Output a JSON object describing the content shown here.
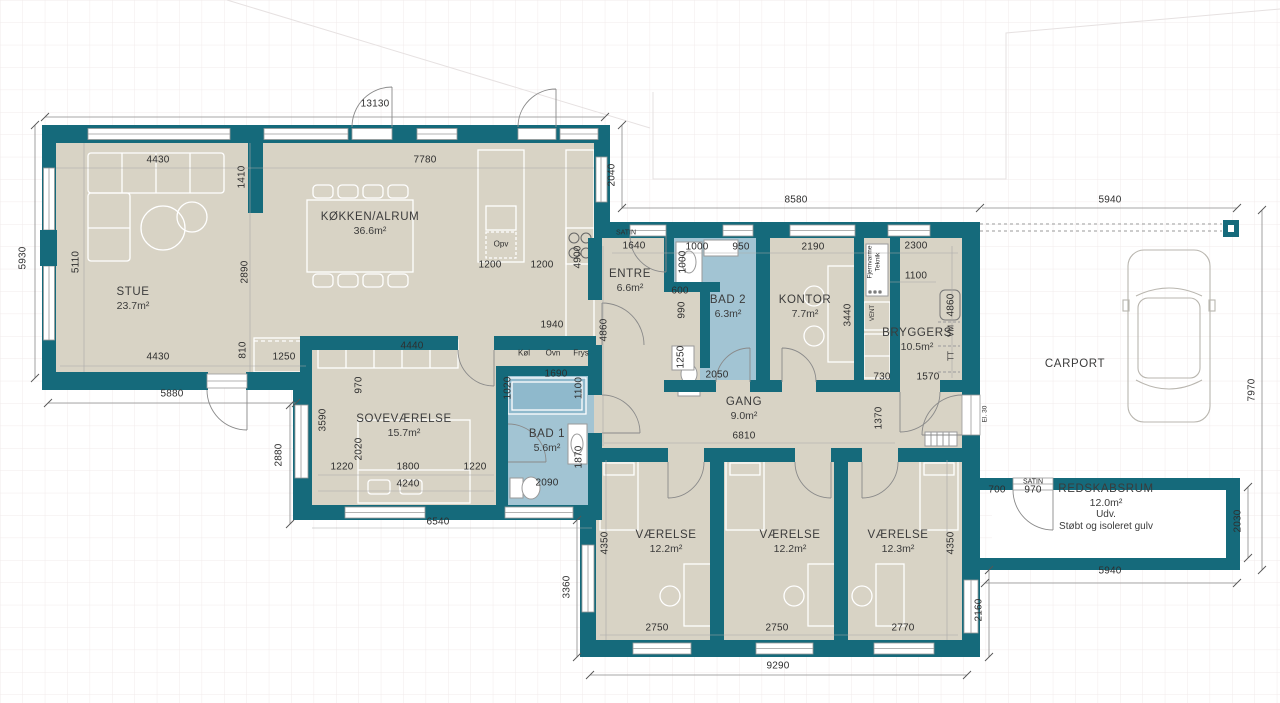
{
  "plan": {
    "colors": {
      "wall": "#156a7b",
      "floor": "#d8d3c5",
      "wet_floor": "#a2c4d3",
      "shower": "#8fb9cc",
      "grid": "#f1ebeb",
      "dim_line": "#8a8a8a",
      "furniture_line": "#ffffff"
    },
    "rooms": [
      {
        "name": "STUE",
        "area": "23.7m²",
        "x": 133,
        "y": 299
      },
      {
        "name": "KØKKEN/ALRUM",
        "area": "36.6m²",
        "x": 370,
        "y": 224
      },
      {
        "name": "SOVEVÆRELSE",
        "area": "15.7m²",
        "x": 404,
        "y": 426
      },
      {
        "name": "BAD 1",
        "area": "5.6m²",
        "x": 547,
        "y": 441
      },
      {
        "name": "ENTRE",
        "area": "6.6m²",
        "x": 630,
        "y": 281
      },
      {
        "name": "BAD 2",
        "area": "6.3m²",
        "x": 728,
        "y": 307
      },
      {
        "name": "KONTOR",
        "area": "7.7m²",
        "x": 805,
        "y": 307
      },
      {
        "name": "BRYGGERS",
        "area": "10.5m²",
        "x": 917,
        "y": 340
      },
      {
        "name": "GANG",
        "area": "9.0m²",
        "x": 744,
        "y": 409
      },
      {
        "name": "VÆRELSE",
        "area": "12.2m²",
        "x": 666,
        "y": 542
      },
      {
        "name": "VÆRELSE",
        "area": "12.2m²",
        "x": 790,
        "y": 542
      },
      {
        "name": "VÆRELSE",
        "area": "12.3m²",
        "x": 898,
        "y": 542
      },
      {
        "name": "CARPORT",
        "area": "",
        "x": 1075,
        "y": 365
      },
      {
        "name": "REDSKABSRUM",
        "area": "12.0m²",
        "x": 1106,
        "y": 508,
        "lines": [
          "Udv.",
          "Støbt og isoleret gulv"
        ]
      }
    ],
    "dims": [
      {
        "t": "13130",
        "x": 375,
        "y": 104
      },
      {
        "t": "4430",
        "x": 158,
        "y": 160
      },
      {
        "t": "7780",
        "x": 425,
        "y": 160
      },
      {
        "t": "1200",
        "x": 490,
        "y": 265
      },
      {
        "t": "1200",
        "x": 542,
        "y": 265
      },
      {
        "t": "4430",
        "x": 158,
        "y": 357
      },
      {
        "t": "1250",
        "x": 284,
        "y": 357
      },
      {
        "t": "4440",
        "x": 412,
        "y": 346
      },
      {
        "t": "1940",
        "x": 552,
        "y": 325
      },
      {
        "t": "1690",
        "x": 556,
        "y": 374
      },
      {
        "t": "2090",
        "x": 547,
        "y": 483
      },
      {
        "t": "5880",
        "x": 172,
        "y": 394
      },
      {
        "t": "1220",
        "x": 342,
        "y": 467
      },
      {
        "t": "1800",
        "x": 408,
        "y": 467
      },
      {
        "t": "1220",
        "x": 475,
        "y": 467
      },
      {
        "t": "4240",
        "x": 408,
        "y": 484
      },
      {
        "t": "6540",
        "x": 438,
        "y": 522
      },
      {
        "t": "1640",
        "x": 634,
        "y": 246
      },
      {
        "t": "1000",
        "x": 697,
        "y": 247
      },
      {
        "t": "950",
        "x": 741,
        "y": 247
      },
      {
        "t": "2190",
        "x": 813,
        "y": 247
      },
      {
        "t": "2300",
        "x": 916,
        "y": 246
      },
      {
        "t": "1100",
        "x": 916,
        "y": 276
      },
      {
        "t": "600",
        "x": 680,
        "y": 291
      },
      {
        "t": "2050",
        "x": 717,
        "y": 375
      },
      {
        "t": "730",
        "x": 882,
        "y": 377
      },
      {
        "t": "1570",
        "x": 928,
        "y": 377
      },
      {
        "t": "8580",
        "x": 796,
        "y": 200
      },
      {
        "t": "5940",
        "x": 1110,
        "y": 200
      },
      {
        "t": "6810",
        "x": 744,
        "y": 436
      },
      {
        "t": "2750",
        "x": 657,
        "y": 628
      },
      {
        "t": "2750",
        "x": 777,
        "y": 628
      },
      {
        "t": "2770",
        "x": 903,
        "y": 628
      },
      {
        "t": "9290",
        "x": 778,
        "y": 666
      },
      {
        "t": "700",
        "x": 997,
        "y": 490
      },
      {
        "t": "970",
        "x": 1033,
        "y": 490
      },
      {
        "t": "5940",
        "x": 1110,
        "y": 571
      },
      {
        "t": "5930",
        "x": 23,
        "y": 258,
        "r": 1
      },
      {
        "t": "5110",
        "x": 76,
        "y": 262,
        "r": 1
      },
      {
        "t": "1410",
        "x": 242,
        "y": 177,
        "r": 1
      },
      {
        "t": "2890",
        "x": 245,
        "y": 272,
        "r": 1
      },
      {
        "t": "810",
        "x": 243,
        "y": 350,
        "r": 1
      },
      {
        "t": "2040",
        "x": 612,
        "y": 175,
        "r": 1
      },
      {
        "t": "4900",
        "x": 578,
        "y": 257,
        "r": 1
      },
      {
        "t": "4860",
        "x": 604,
        "y": 330,
        "r": 1
      },
      {
        "t": "1000",
        "x": 683,
        "y": 262,
        "r": 1
      },
      {
        "t": "990",
        "x": 682,
        "y": 310,
        "r": 1
      },
      {
        "t": "1250",
        "x": 681,
        "y": 357,
        "r": 1
      },
      {
        "t": "3440",
        "x": 848,
        "y": 315,
        "r": 1
      },
      {
        "t": "4860",
        "x": 951,
        "y": 305,
        "r": 1
      },
      {
        "t": "1020",
        "x": 508,
        "y": 388,
        "r": 1
      },
      {
        "t": "1100",
        "x": 579,
        "y": 388,
        "r": 1
      },
      {
        "t": "1870",
        "x": 579,
        "y": 457,
        "r": 1
      },
      {
        "t": "970",
        "x": 359,
        "y": 385,
        "r": 1
      },
      {
        "t": "3590",
        "x": 323,
        "y": 420,
        "r": 1
      },
      {
        "t": "2020",
        "x": 359,
        "y": 449,
        "r": 1
      },
      {
        "t": "2880",
        "x": 279,
        "y": 455,
        "r": 1
      },
      {
        "t": "1370",
        "x": 879,
        "y": 418,
        "r": 1
      },
      {
        "t": "3360",
        "x": 567,
        "y": 587,
        "r": 1
      },
      {
        "t": "4350",
        "x": 605,
        "y": 543,
        "r": 1
      },
      {
        "t": "4350",
        "x": 951,
        "y": 543,
        "r": 1
      },
      {
        "t": "2160",
        "x": 979,
        "y": 610,
        "r": 1
      },
      {
        "t": "2030",
        "x": 1238,
        "y": 521,
        "r": 1
      },
      {
        "t": "7970",
        "x": 1252,
        "y": 390,
        "r": 1
      }
    ],
    "labels": [
      {
        "t": "SATIN",
        "x": 626,
        "y": 233,
        "s": 7
      },
      {
        "t": "SATIN",
        "x": 1033,
        "y": 482,
        "s": 7
      },
      {
        "t": "Køl",
        "x": 524,
        "y": 353,
        "s": 8
      },
      {
        "t": "Ovn",
        "x": 553,
        "y": 353,
        "s": 8
      },
      {
        "t": "Frys",
        "x": 581,
        "y": 353,
        "s": 8
      },
      {
        "t": "Opv",
        "x": 501,
        "y": 244,
        "s": 8
      },
      {
        "t": "VM",
        "x": 951,
        "y": 331,
        "s": 8,
        "r": 1
      },
      {
        "t": "TT",
        "x": 951,
        "y": 356,
        "s": 8,
        "r": 1
      },
      {
        "t": "VENT",
        "x": 873,
        "y": 313,
        "s": 6,
        "r": 1
      },
      {
        "t": "Fjernvarme",
        "x": 870,
        "y": 262,
        "s": 6.5,
        "r": 1
      },
      {
        "t": "Teknik",
        "x": 878,
        "y": 262,
        "s": 6.5,
        "r": 1
      },
      {
        "t": "El. 30",
        "x": 985,
        "y": 414,
        "s": 6.5,
        "r": 1
      }
    ]
  }
}
